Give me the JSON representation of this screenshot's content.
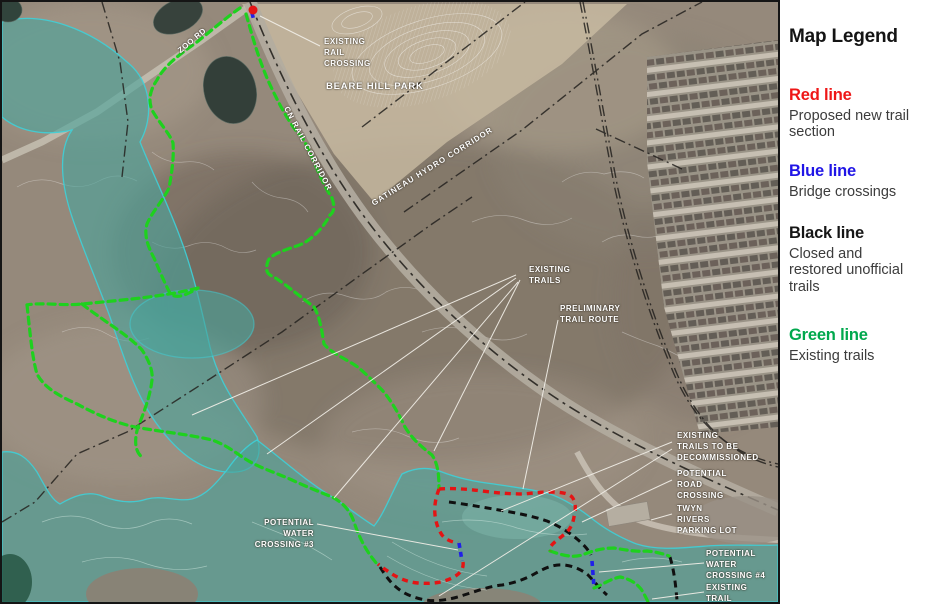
{
  "legend": {
    "title": "Map Legend",
    "entries": [
      {
        "name": "Red line",
        "color": "#ee1717",
        "desc": "Proposed new trail\nsection"
      },
      {
        "name": "Blue line",
        "color": "#2015e6",
        "desc": "Bridge crossings"
      },
      {
        "name": "Black line",
        "color": "#161616",
        "desc": "Closed and\nrestored unofficial\ntrails"
      },
      {
        "name": "Green line",
        "color": "#00a84d",
        "desc": "Existing trails"
      }
    ]
  },
  "map": {
    "labels": {
      "zoo_rd": "ZOO RD",
      "cn_rail_corridor": "CN RAIL CORRIDOR",
      "gatineau_hydro_corridor": "GATINEAU HYDRO CORRIDOR",
      "beare_hill_park": "BEARE HILL PARK",
      "existing_rail_crossing": "EXISTING\nRAIL\nCROSSING",
      "existing_trails": "EXISTING\nTRAILS",
      "preliminary_trail_route": "PRELIMINARY\nTRAIL ROUTE",
      "existing_trails_to_be_decommissioned": "EXISTING\nTRAILS TO BE\nDECOMMISSIONED",
      "potential_road_crossing": "POTENTIAL\nROAD\nCROSSING",
      "twyn_rivers_parking_lot": "TWYN\nRIVERS\nPARKING LOT",
      "potential_water_crossing_3": "POTENTIAL\nWATER\nCROSSING #3",
      "potential_water_crossing_4": "POTENTIAL\nWATER\nCROSSING #4",
      "existing_trail": "EXISTING\nTRAIL"
    },
    "trail_colors": {
      "proposed_new_trail": "#e41414",
      "bridge_crossing": "#2020e8",
      "closed_restored_trail": "#101010",
      "existing_trail": "#1ed11e"
    },
    "overlay_colors": {
      "floodplain_fill": "#4aa39b",
      "floodplain_outline": "#3ed0d8"
    }
  }
}
